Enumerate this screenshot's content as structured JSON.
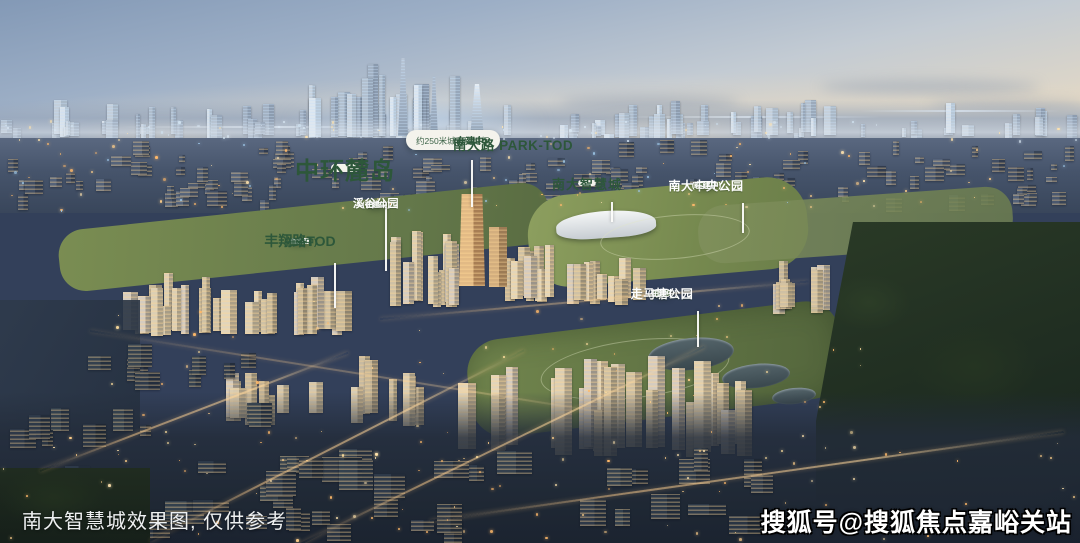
{
  "labels": {
    "park_tod": {
      "title": "南大路 PARK-TOD",
      "status": "(在建中)",
      "subtitle": "约250米城市新地标"
    },
    "zhonghuan_ludao": {
      "title": "中环麓岛"
    },
    "xigu_park": {
      "title": "溪谷公园",
      "status": "(在建中)"
    },
    "fengxiang_tod": {
      "title": "丰翔路TOD",
      "status": "(在建中)"
    },
    "nanda_smart_city": {
      "title": "南大智慧城"
    },
    "nanda_central_park": {
      "title": "南大中央公园",
      "status": "(在建中)"
    },
    "zoumatang_park": {
      "title": "走马塘公园",
      "status": "(在建中)"
    }
  },
  "footer": {
    "caption": "南大智慧城效果图, 仅供参考",
    "watermark": "搜狐号@搜狐焦点嘉峪关站"
  },
  "colors": {
    "badge_white": "#f4f3ec",
    "badge_green": "#5c7a50",
    "text_green": "#2d573a",
    "leader_line": "#fcfcfa"
  }
}
